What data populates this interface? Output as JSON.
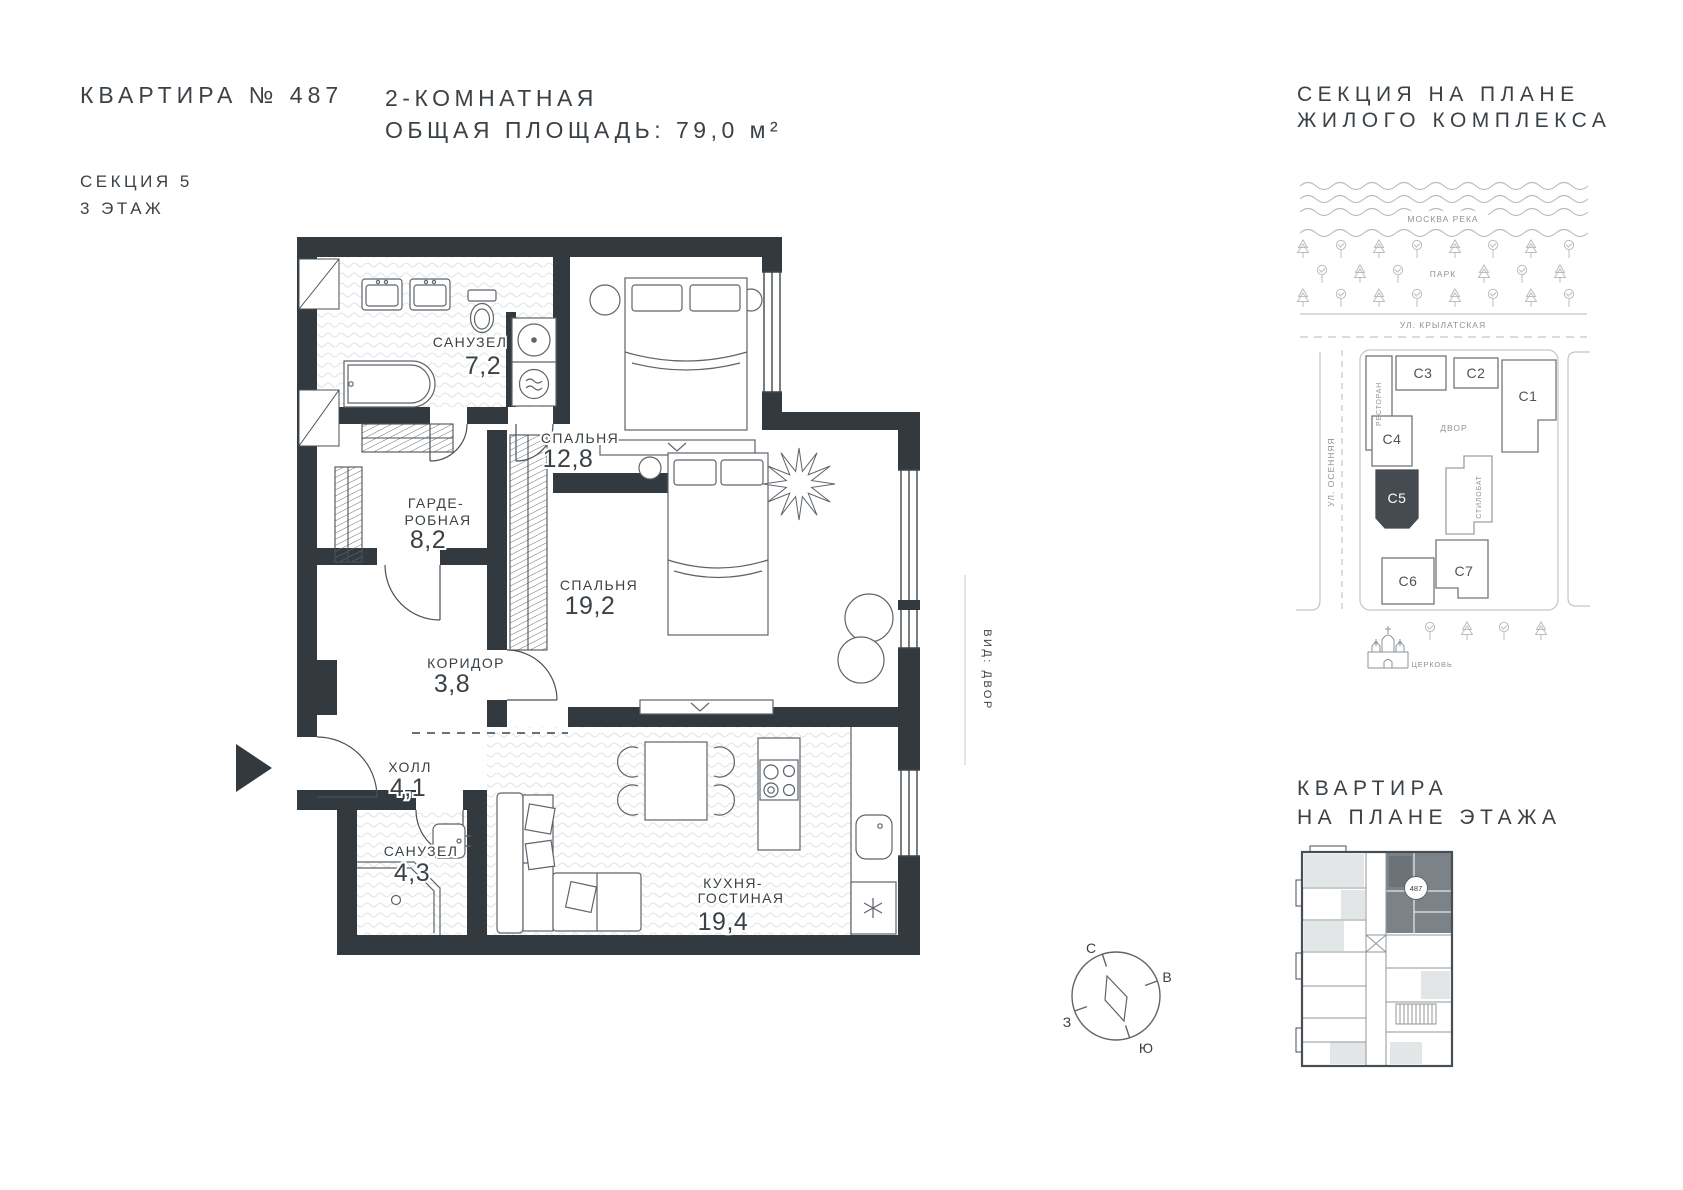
{
  "header": {
    "apartment": "КВАРТИРА № 487",
    "section": "СЕКЦИЯ 5",
    "floor": "3 ЭТАЖ",
    "rooms_type": "2-КОМНАТНАЯ",
    "total_area": "ОБЩАЯ ПЛОЩАДЬ: 79,0 м²"
  },
  "plan": {
    "rooms": {
      "bath1": {
        "name": "САНУЗЕЛ",
        "area": "7,2"
      },
      "bedroom1": {
        "name": "СПАЛЬНЯ",
        "area": "12,8"
      },
      "wardrobe": {
        "name_line1": "ГАРДЕ-",
        "name_line2": "РОБНАЯ",
        "area": "8,2"
      },
      "bedroom2": {
        "name": "СПАЛЬНЯ",
        "area": "19,2"
      },
      "corridor": {
        "name": "КОРИДОР",
        "area": "3,8"
      },
      "hall": {
        "name": "ХОЛЛ",
        "area": "4,1"
      },
      "bath2": {
        "name": "САНУЗЕЛ",
        "area": "4,3"
      },
      "kitchen": {
        "name_line1": "КУХНЯ-",
        "name_line2": "ГОСТИНАЯ",
        "area": "19,4"
      }
    },
    "view_label": "ВИД: ДВОР"
  },
  "site_map": {
    "title_line1": "СЕКЦИЯ НА ПЛАНЕ",
    "title_line2": "ЖИЛОГО КОМПЛЕКСА",
    "river": "МОСКВА РЕКА",
    "park": "ПАРК",
    "street_top": "УЛ. КРЫЛАТСКАЯ",
    "street_left": "УЛ. ОСЕННЯЯ",
    "restaurant": "РЕСТОРАН",
    "courtyard": "ДВОР",
    "stylobate": "СТИЛОБАТ",
    "church": "ЦЕРКОВЬ",
    "sections": {
      "c1": "С1",
      "c2": "С2",
      "c3": "С3",
      "c4": "С4",
      "c5": "С5",
      "c6": "С6",
      "c7": "С7"
    },
    "highlighted_section": "С5"
  },
  "floor_widget": {
    "title_line1": "КВАРТИРА",
    "title_line2": "НА ПЛАНЕ ЭТАЖА",
    "badge": "487"
  },
  "compass": {
    "n": "С",
    "e": "В",
    "s": "Ю",
    "w": "З"
  },
  "colors": {
    "wall": "#333a3f",
    "text": "#3b4247",
    "highlight_section": "#454b51",
    "map_line": "#b9bdc0",
    "floor_hatch": "#e2e5e6"
  }
}
